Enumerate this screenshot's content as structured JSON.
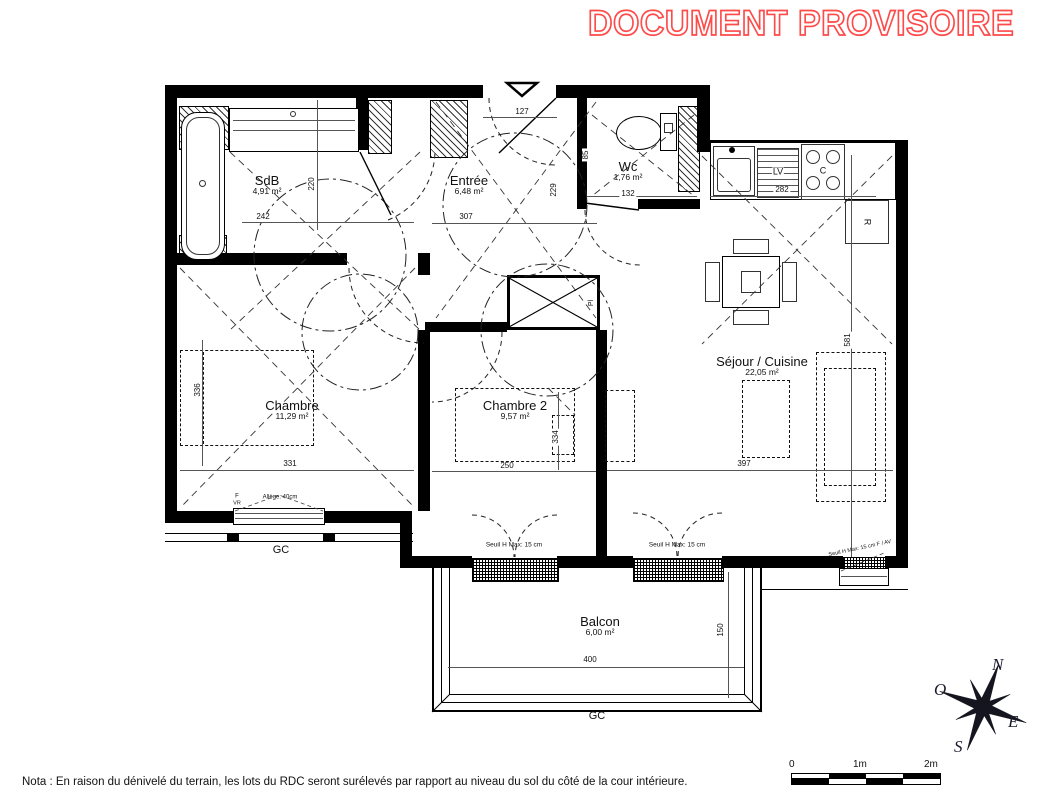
{
  "stamp": {
    "text": "DOCUMENT PROVISOIRE",
    "color": "#ff4a4a"
  },
  "note": "Nota : En raison du dénivelé du terrain, les lots du RDC seront surélevés par rapport au niveau du sol du côté de la cour intérieure.",
  "rooms": {
    "sdb": {
      "name": "SdB",
      "area": "4,91 m²"
    },
    "entree": {
      "name": "Entrée",
      "area": "6,48 m²"
    },
    "wc": {
      "name": "Wc",
      "area": "1,76 m²"
    },
    "sejour": {
      "name": "Séjour / Cuisine",
      "area": "22,05 m²"
    },
    "chambre": {
      "name": "Chambre",
      "area": "11,29 m²"
    },
    "chambre2": {
      "name": "Chambre 2",
      "area": "9,57 m²"
    },
    "balcon": {
      "name": "Balcon",
      "area": "6,00 m²"
    }
  },
  "dimensions": {
    "d127": "127",
    "d307": "307",
    "d242": "242",
    "d220": "220",
    "d229": "229",
    "d85": "85",
    "d132": "132",
    "d282": "282",
    "d581": "581",
    "d331": "331",
    "d336": "336",
    "d250": "250",
    "d334": "334",
    "d397": "397",
    "d400": "400",
    "d150": "150"
  },
  "labels": {
    "gc1": "GC",
    "gc2": "GC",
    "lv": "LV",
    "cooktop": "C",
    "fridge": "R",
    "placard": "Pl",
    "seuil1": "Seuil H Max: 15 cm",
    "seuil2": "Seuil H Max: 15 cm",
    "seuil3": "Seuil H Max: 15 cm F / AV",
    "allege": "Allège: 40cm",
    "f": "F",
    "vr": "VR"
  },
  "compass": {
    "n": "N",
    "o": "O",
    "e": "E",
    "s": "S"
  },
  "scalebar": {
    "t0": "0",
    "t1": "1m",
    "t2": "2m"
  }
}
